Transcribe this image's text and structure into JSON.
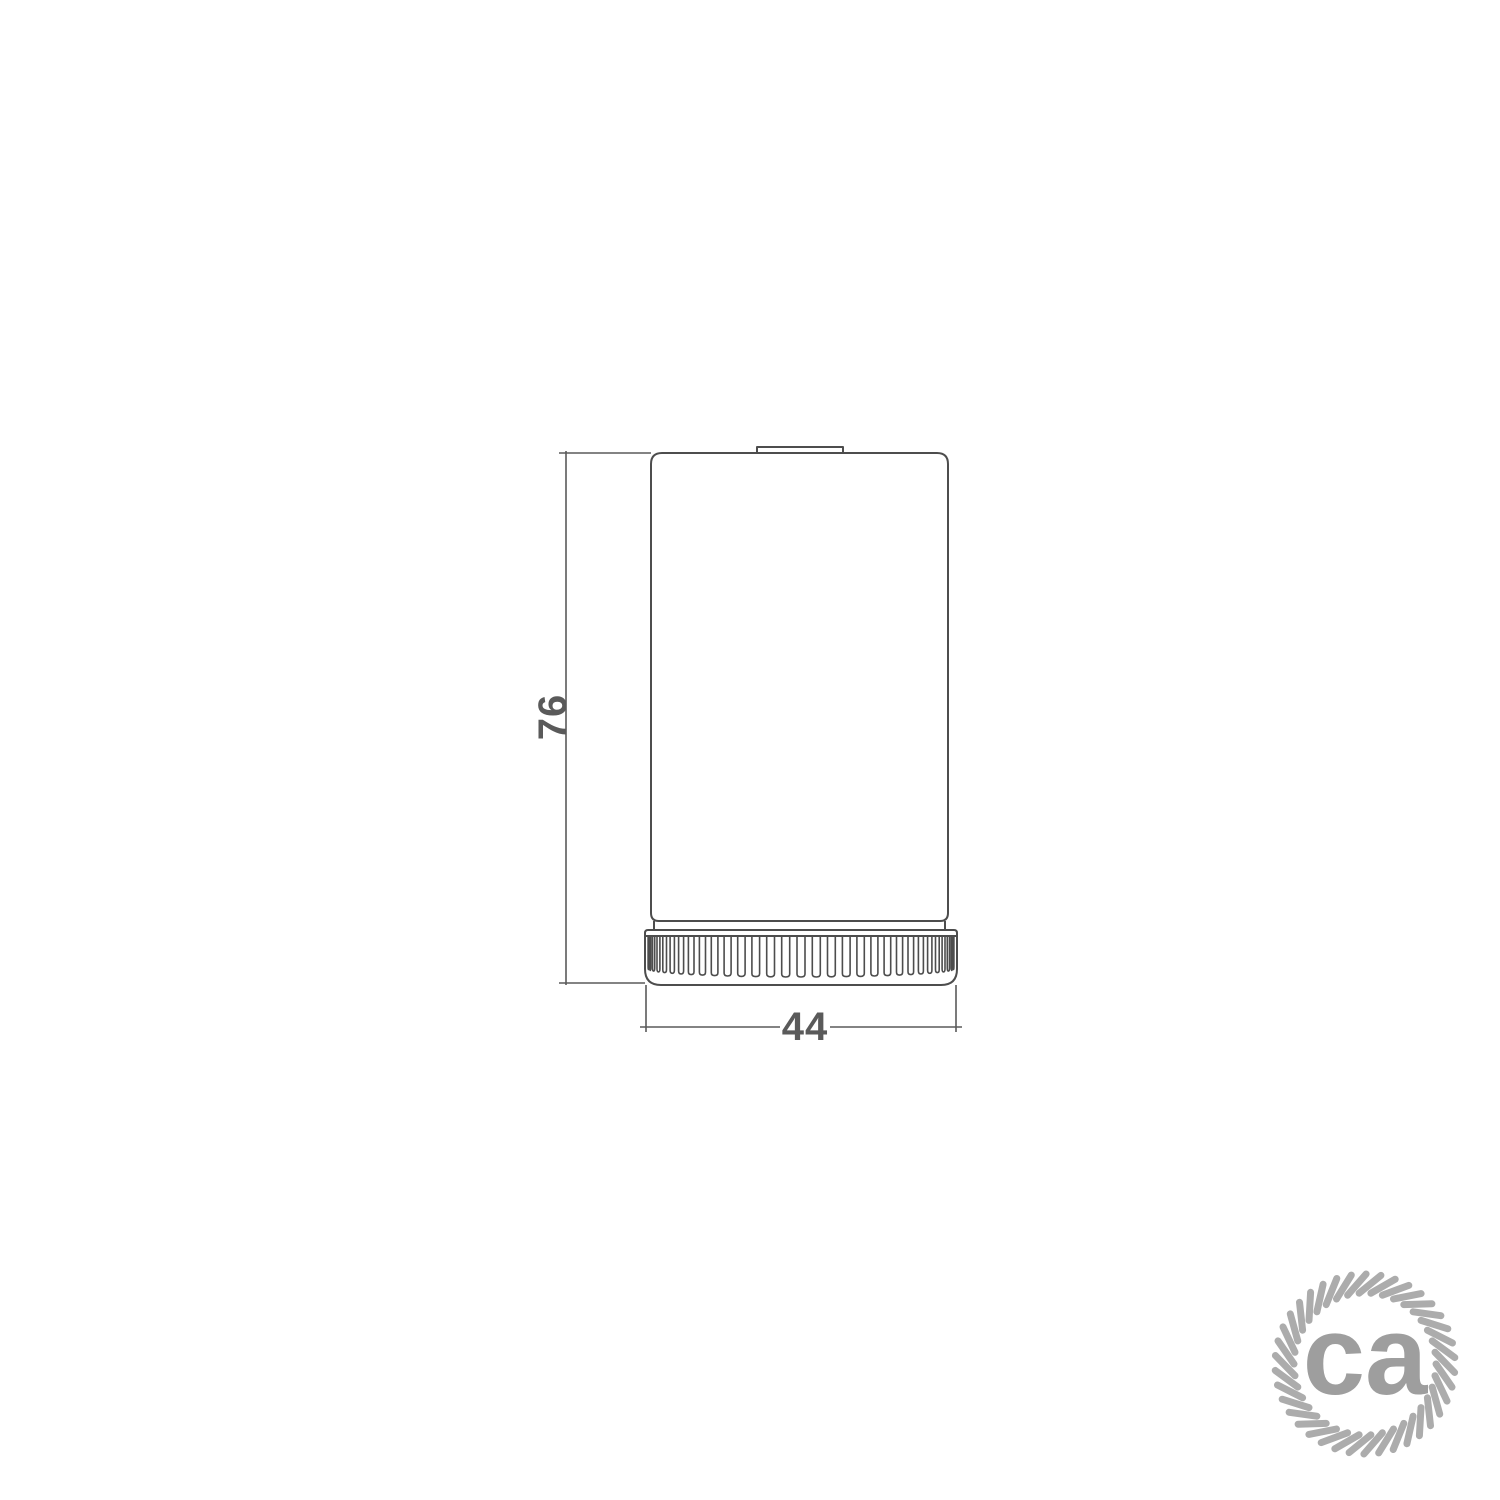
{
  "page": {
    "background": "#ffffff"
  },
  "drawing": {
    "line_color": "#4d4d4d",
    "dimension_line_color": "#5a5a5a",
    "dimension_text_color": "#5a5a5a",
    "dimensions": {
      "height": "76",
      "width": "44"
    }
  },
  "logo": {
    "text": "ca",
    "rope_color": "#acacac",
    "text_color": "#9e9e9e"
  }
}
